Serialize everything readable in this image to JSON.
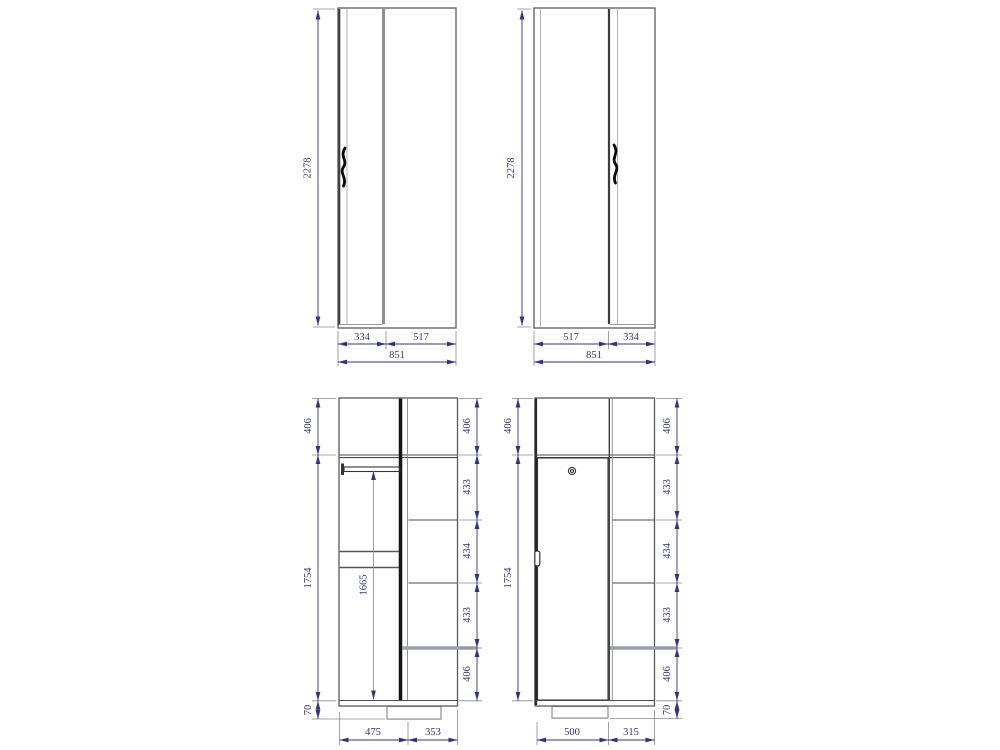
{
  "colors": {
    "background": "#ffffff",
    "outline": "#5a5a5a",
    "divider": "#141414",
    "door_edge": "#8f8f8f",
    "highlight": "#9ba1ac",
    "handle": "#0a0a0a",
    "dimension": "#31318f"
  },
  "views": {
    "front_a": {
      "height": "2278",
      "door_width": "334",
      "cabinet_width": "517",
      "total_width": "851"
    },
    "front_b": {
      "height": "2278",
      "cabinet_width": "517",
      "door_width": "334",
      "total_width": "851"
    },
    "interior_a": {
      "top_section": "406",
      "body_height": "1754",
      "plinth_height": "70",
      "rod_clearance": "1665",
      "right_sections": [
        "406",
        "433",
        "434",
        "433",
        "406"
      ],
      "left_width": "475",
      "right_width": "353"
    },
    "interior_b": {
      "top_section": "406",
      "body_height": "1754",
      "plinth_height": "70",
      "right_sections": [
        "406",
        "433",
        "434",
        "433",
        "406"
      ],
      "door_width": "500",
      "shelf_width": "315"
    }
  }
}
